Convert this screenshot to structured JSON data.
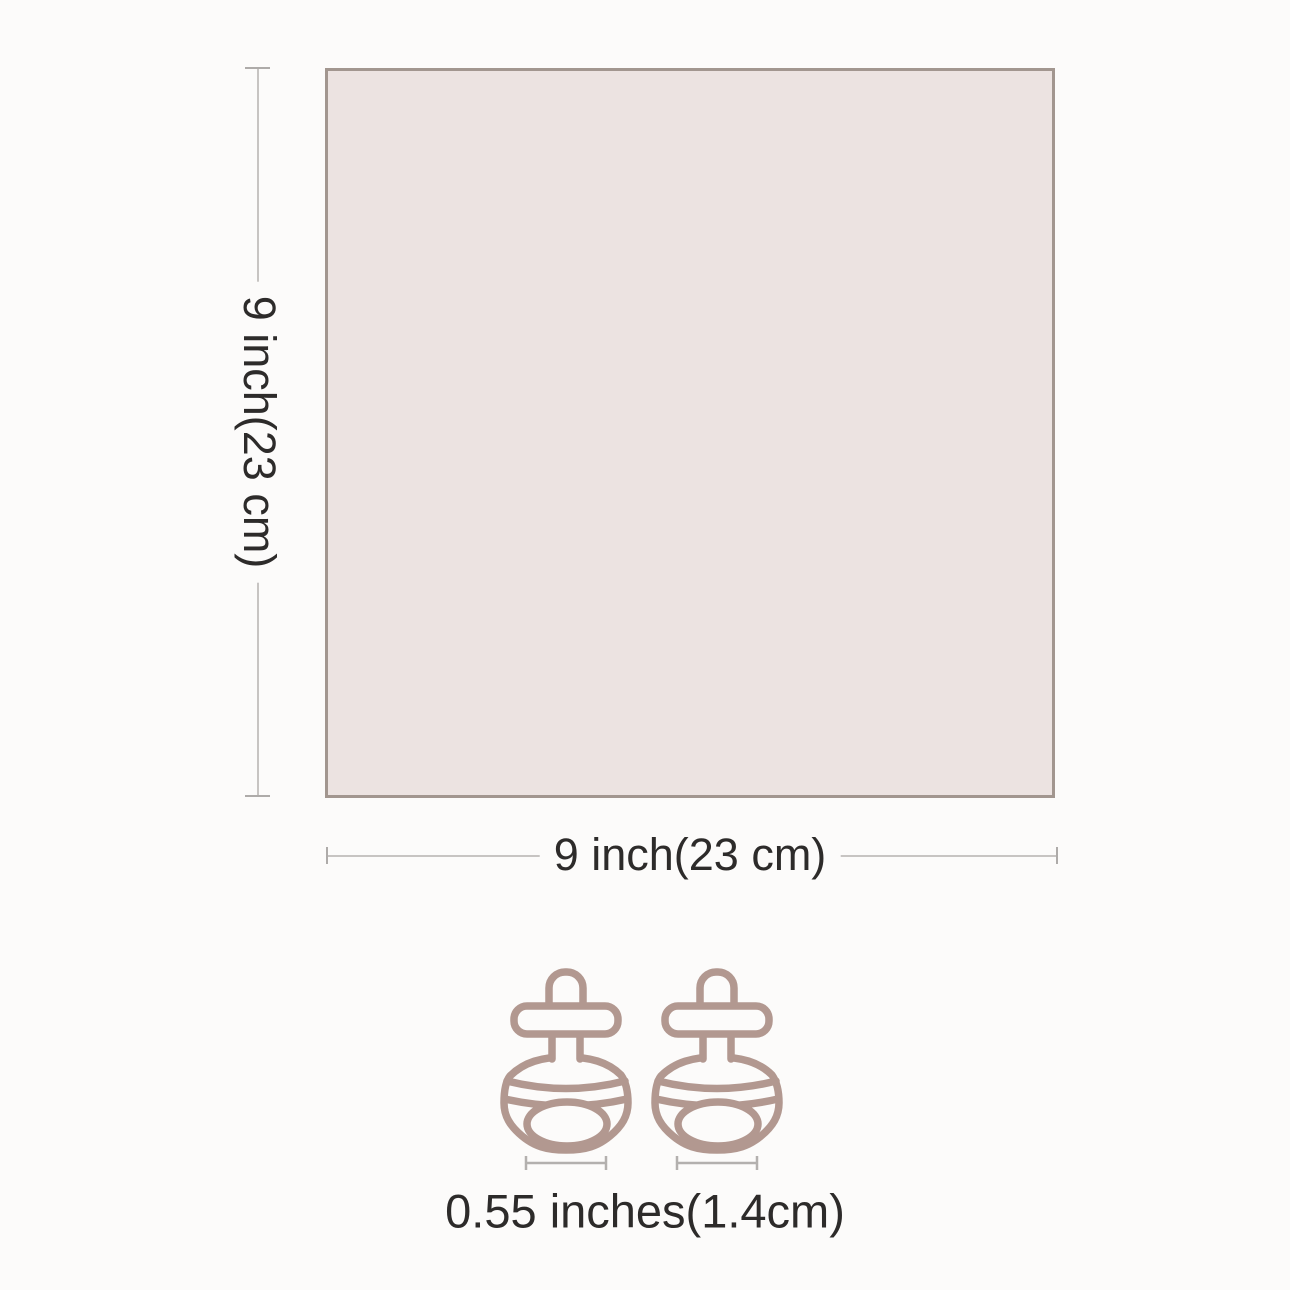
{
  "diagram": {
    "title": "product-size-diagram",
    "square": {
      "fill": "#ece3e1",
      "border_color": "#a2968f"
    },
    "height_dimension": {
      "label": "9 inch(23 cm)"
    },
    "width_dimension": {
      "label": "9 inch(23 cm)"
    },
    "fastener_dimension": {
      "label": "0.55 inches(1.4cm)"
    },
    "fasteners": {
      "count": 2,
      "icon": "screw-rivet-icon",
      "outline_color": "#b29890"
    },
    "colors": {
      "background": "#fcfbfa",
      "dimension_line": "#c7c4c2",
      "text": "#2d2b2a"
    }
  }
}
